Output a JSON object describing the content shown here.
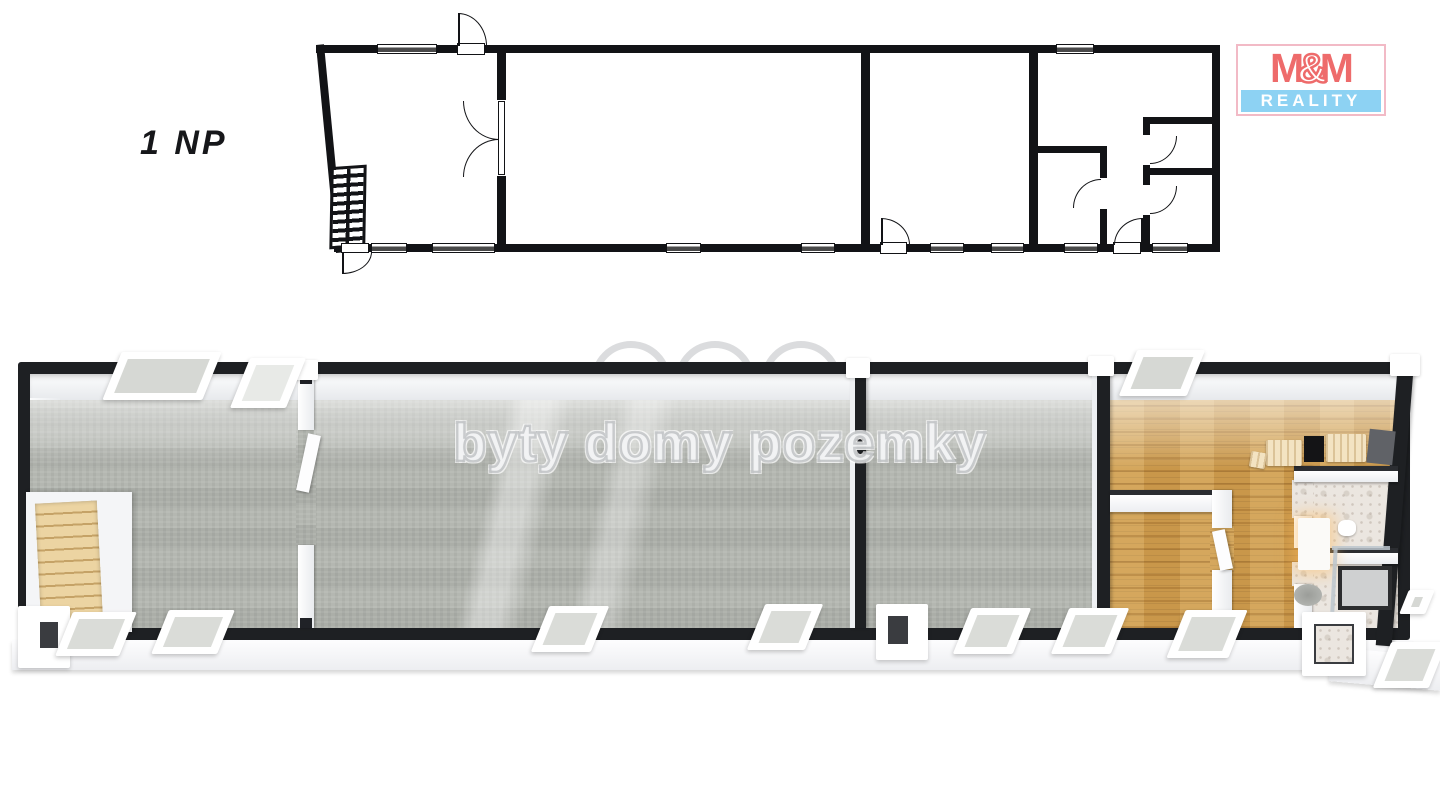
{
  "floor_plan_2d": {
    "label": "1 NP"
  },
  "logo": {
    "m_left": "M",
    "amp": "&",
    "m_right": "M",
    "reality": "REALITY"
  },
  "watermark": {
    "text": "byty domy pozemky",
    "icons": [
      "signal-waves-icon",
      "house-roof-icon",
      "stacked-layers-icon"
    ]
  },
  "colors": {
    "ink": "#121316",
    "wall3d": "#1e2023",
    "carpet": "#b4b7b1",
    "wood": "#c9974a",
    "tile": "#ebe6e0",
    "stairwood": "#ecd4a2",
    "logored": "#ee6b6b",
    "logoblue": "#8dd2f3",
    "logopink": "#f2bac6",
    "wm": "#c6c8ca"
  }
}
